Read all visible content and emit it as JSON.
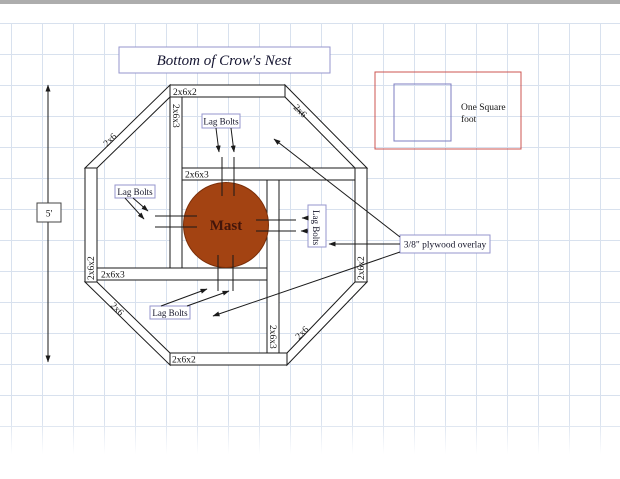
{
  "title": "Bottom of Crow's Nest",
  "legend": {
    "line1": "One Square",
    "line2": "foot"
  },
  "dimension_label": "5'",
  "mast_label": "Mast",
  "callouts": {
    "lag_top": "Lag Bolts",
    "lag_left": "Lag Bolts",
    "lag_right": "Lag Bolts",
    "lag_bottom": "Lag Bolts",
    "plywood": "3/8\" plywood overlay"
  },
  "members": {
    "top": "2x6x2",
    "bottom": "2x6x2",
    "left": "2x6x2",
    "right": "2x6x2",
    "diag_tl": "2x6",
    "diag_tr": "2x6",
    "diag_bl": "2x6",
    "diag_br": "2x6",
    "inner_top_vert": "2x6x3",
    "inner_upper_horiz": "2x6x3",
    "inner_lower_horiz": "2x6x3",
    "inner_bottom_vert": "2x6x3"
  },
  "colors": {
    "line": "#1a1a1a",
    "callout_border": "#9595cd",
    "legend_border_red": "#cc5450",
    "legend_square_blue": "#7d7dc1",
    "mast_fill": "#a34312",
    "mast_stroke": "#7a2e08",
    "grid": "#d8e1ee",
    "topbar": "#adadad"
  }
}
